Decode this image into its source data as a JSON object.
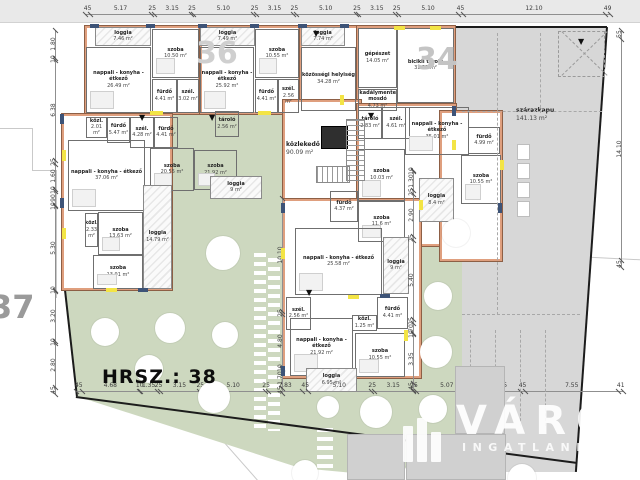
{
  "title": {
    "hrsz_label": "HRSZ.: 38"
  },
  "parcel_numbers": {
    "left": "37",
    "middle": "36",
    "right": "34"
  },
  "watermark": {
    "line1": "VÁROS",
    "line2": "INGATLANIRODA"
  },
  "colors": {
    "garden_green": "#cdd8bf",
    "pavement_gray": "#d7d7d7",
    "wall_salmon": "#df9f7e",
    "window_blue": "#3d5377",
    "marker_yellow": "#f3e445"
  },
  "rooms": [
    {
      "name": "loggia",
      "area": "7.46 m²",
      "x": 95,
      "y": 27,
      "w": 56,
      "h": 19,
      "k": "l"
    },
    {
      "name": "szoba",
      "area": "10.50 m²",
      "x": 152,
      "y": 29,
      "w": 47,
      "h": 49,
      "k": "r",
      "f": 1
    },
    {
      "name": "nappali - konyha - étkező",
      "area": "26.49 m²",
      "x": 86,
      "y": 47,
      "w": 65,
      "h": 66,
      "k": "r",
      "f": 1
    },
    {
      "name": "fürdő",
      "area": "4.41 m²",
      "x": 152,
      "y": 79,
      "w": 25,
      "h": 34,
      "k": "r"
    },
    {
      "name": "szél.",
      "area": "3.02 m²",
      "x": 177,
      "y": 79,
      "w": 22,
      "h": 34,
      "k": "r"
    },
    {
      "name": "loggia",
      "area": "7.49 m²",
      "x": 200,
      "y": 27,
      "w": 55,
      "h": 19,
      "k": "l"
    },
    {
      "name": "szoba",
      "area": "10.55 m²",
      "x": 255,
      "y": 29,
      "w": 44,
      "h": 49,
      "k": "r",
      "f": 1
    },
    {
      "name": "nappali - konyha - étkező",
      "area": "25.92 m²",
      "x": 200,
      "y": 47,
      "w": 54,
      "h": 66,
      "k": "r",
      "f": 1
    },
    {
      "name": "fürdő",
      "area": "4.41 m²",
      "x": 255,
      "y": 79,
      "w": 23,
      "h": 34,
      "k": "r"
    },
    {
      "name": "szél.",
      "area": "2.56 m²",
      "x": 278,
      "y": 79,
      "w": 21,
      "h": 34,
      "k": "r"
    },
    {
      "name": "loggia",
      "area": "7.74 m²",
      "x": 301,
      "y": 27,
      "w": 44,
      "h": 19,
      "k": "l"
    },
    {
      "name": "közösségi helyiség",
      "area": "34.28 m²",
      "x": 301,
      "y": 47,
      "w": 55,
      "h": 64,
      "k": "r"
    },
    {
      "name": "gépészet",
      "area": "14.05 m²",
      "x": 358,
      "y": 28,
      "w": 39,
      "h": 60,
      "k": "r"
    },
    {
      "name": "bicikli tároló",
      "area": "31.37 m²",
      "x": 397,
      "y": 28,
      "w": 57,
      "h": 75,
      "k": "r"
    },
    {
      "name": "akadálymentes mosdó",
      "area": "4.73 m²",
      "x": 358,
      "y": 89,
      "w": 39,
      "h": 22,
      "k": "r"
    },
    {
      "name": "közl.",
      "area": "2.01 m²",
      "x": 86,
      "y": 117,
      "w": 21,
      "h": 21,
      "k": "r"
    },
    {
      "name": "fürdő",
      "area": "5.47 m²",
      "x": 107,
      "y": 117,
      "w": 23,
      "h": 26,
      "k": "r"
    },
    {
      "name": "szél.",
      "area": "4.28 m²",
      "x": 130,
      "y": 117,
      "w": 24,
      "h": 31,
      "k": "r"
    },
    {
      "name": "fürdő",
      "area": "4.41 m²",
      "x": 154,
      "y": 117,
      "w": 24,
      "h": 31,
      "k": "r"
    },
    {
      "name": "tároló",
      "area": "2.56 m²",
      "x": 215,
      "y": 111,
      "w": 24,
      "h": 26,
      "k": "r"
    },
    {
      "name": "nappali - konyha - étkező",
      "area": "37.06 m²",
      "x": 68,
      "y": 140,
      "w": 77,
      "h": 71,
      "k": "r",
      "f": 1
    },
    {
      "name": "szoba",
      "area": "20.55 m²",
      "x": 150,
      "y": 148,
      "w": 44,
      "h": 43,
      "k": "r",
      "f": 1
    },
    {
      "name": "szoba",
      "area": "21.92 m²",
      "x": 194,
      "y": 150,
      "w": 43,
      "h": 40,
      "k": "r",
      "f": 1
    },
    {
      "name": "közl.",
      "area": "2.33 m²",
      "x": 85,
      "y": 213,
      "w": 13,
      "h": 34,
      "k": "r"
    },
    {
      "name": "szoba",
      "area": "13.63 m²",
      "x": 98,
      "y": 212,
      "w": 45,
      "h": 43,
      "k": "r",
      "f": 1
    },
    {
      "name": "szoba",
      "area": "13.91 m²",
      "x": 93,
      "y": 255,
      "w": 50,
      "h": 34,
      "k": "r",
      "f": 1
    },
    {
      "name": "loggia",
      "area": "14.79 m²",
      "x": 143,
      "y": 185,
      "w": 29,
      "h": 104,
      "k": "l"
    },
    {
      "name": "loggia",
      "area": "9 m²",
      "x": 210,
      "y": 176,
      "w": 52,
      "h": 23,
      "k": "l"
    },
    {
      "name": "tároló",
      "area": "2.83 m²",
      "x": 358,
      "y": 107,
      "w": 24,
      "h": 32,
      "k": "r"
    },
    {
      "name": "szél.",
      "area": "4.61 m²",
      "x": 382,
      "y": 107,
      "w": 28,
      "h": 32,
      "k": "r"
    },
    {
      "name": "nappali - konyha - étkező",
      "area": "35.01 m²",
      "x": 405,
      "y": 107,
      "w": 64,
      "h": 48,
      "k": "r",
      "f": 1
    },
    {
      "name": "szoba",
      "area": "10.03 m²",
      "x": 358,
      "y": 149,
      "w": 47,
      "h": 52,
      "k": "r",
      "f": 1
    },
    {
      "name": "fürdő",
      "area": "4.37 m²",
      "x": 330,
      "y": 191,
      "w": 28,
      "h": 31,
      "k": "r"
    },
    {
      "name": "szoba",
      "area": "11.6 m²",
      "x": 358,
      "y": 201,
      "w": 47,
      "h": 41,
      "k": "r",
      "f": 1
    },
    {
      "name": "fürdő",
      "area": "4.99 m²",
      "x": 468,
      "y": 127,
      "w": 32,
      "h": 27,
      "k": "r"
    },
    {
      "name": "szoba",
      "area": "10.55 m²",
      "x": 461,
      "y": 155,
      "w": 40,
      "h": 49,
      "k": "r",
      "f": 1
    },
    {
      "name": "loggia",
      "area": "8.4 m²",
      "x": 419,
      "y": 178,
      "w": 35,
      "h": 44,
      "k": "l"
    },
    {
      "name": "nappali - konyha - étkező",
      "area": "25.58 m²",
      "x": 295,
      "y": 228,
      "w": 87,
      "h": 67,
      "k": "r",
      "f": 1
    },
    {
      "name": "loggia",
      "area": "9 m²",
      "x": 383,
      "y": 237,
      "w": 26,
      "h": 57,
      "k": "l"
    },
    {
      "name": "szél.",
      "area": "2.56 m²",
      "x": 286,
      "y": 297,
      "w": 25,
      "h": 33,
      "k": "r"
    },
    {
      "name": "fürdő",
      "area": "4.41 m²",
      "x": 377,
      "y": 297,
      "w": 31,
      "h": 32,
      "k": "r"
    },
    {
      "name": "közl.",
      "area": "1.25 m²",
      "x": 352,
      "y": 315,
      "w": 25,
      "h": 16,
      "k": "r"
    },
    {
      "name": "nappali - konyha - étkező",
      "area": "21.92 m²",
      "x": 290,
      "y": 318,
      "w": 63,
      "h": 58,
      "k": "r",
      "f": 1
    },
    {
      "name": "szoba",
      "area": "10.55 m²",
      "x": 355,
      "y": 333,
      "w": 50,
      "h": 44,
      "k": "r",
      "f": 1
    },
    {
      "name": "loggia",
      "area": "6.95 m²",
      "x": 306,
      "y": 368,
      "w": 51,
      "h": 24,
      "k": "l"
    },
    {
      "name": "szárazkapu",
      "area": "141.13 m²",
      "x": 516,
      "y": 106,
      "w": 60,
      "h": 18,
      "k": "t"
    },
    {
      "name": "közlekedő",
      "area": "90.09 m²",
      "x": 286,
      "y": 140,
      "w": 52,
      "h": 18,
      "k": "t"
    }
  ],
  "blocks": [
    [
      85,
      26,
      115,
      88
    ],
    [
      200,
      26,
      100,
      88
    ],
    [
      300,
      26,
      58,
      86
    ],
    [
      357,
      26,
      98,
      86
    ],
    [
      62,
      114,
      110,
      176
    ],
    [
      283,
      100,
      78,
      130
    ],
    [
      357,
      104,
      99,
      142
    ],
    [
      440,
      111,
      62,
      150
    ],
    [
      283,
      199,
      138,
      179
    ]
  ],
  "dimension_chains": [
    {
      "dir": "h",
      "x": 85,
      "y": 14,
      "scale": 11.7,
      "segments": [
        [
          "45",
          0.45
        ],
        [
          "5.17",
          5.17
        ],
        [
          "25",
          0.25
        ],
        [
          "3.15",
          3.15
        ],
        [
          "25",
          0.25
        ],
        [
          "5.10",
          5.1
        ],
        [
          "25",
          0.25
        ],
        [
          "3.15",
          3.15
        ],
        [
          "25",
          0.25
        ],
        [
          "5.10",
          5.1
        ],
        [
          "25",
          0.25
        ],
        [
          "3.15",
          3.15
        ],
        [
          "25",
          0.25
        ],
        [
          "5.10",
          5.1
        ],
        [
          "45",
          0.45
        ],
        [
          "12.10",
          12.1
        ],
        [
          "49",
          0.49
        ]
      ]
    },
    {
      "dir": "h",
      "x": 76,
      "y": 391,
      "scale": 12.3,
      "segments": [
        [
          "45",
          0.45
        ],
        [
          "4.68",
          4.68
        ],
        [
          "10",
          0.1
        ],
        [
          "1.35",
          1.35
        ],
        [
          "25",
          0.25
        ],
        [
          "3.15",
          3.15
        ],
        [
          "25",
          0.25
        ],
        [
          "5.10",
          5.1
        ],
        [
          "25",
          0.25
        ],
        [
          "2.83",
          2.83
        ],
        [
          "45",
          0.45
        ],
        [
          "5.10",
          5.1
        ],
        [
          "25",
          0.25
        ],
        [
          "3.15",
          3.15
        ],
        [
          "25",
          0.25
        ],
        [
          "5.07",
          5.07
        ],
        [
          "25",
          0.25
        ],
        [
          "3.15",
          3.15
        ],
        [
          "45",
          0.45
        ],
        [
          "7.55",
          7.55
        ],
        [
          "41",
          0.41
        ]
      ]
    },
    {
      "dir": "v",
      "x": 55,
      "y": 30,
      "scale": 15.7,
      "segments": [
        [
          "1.80",
          1.8
        ],
        [
          "10",
          0.1
        ],
        [
          "6.38",
          6.38
        ],
        [
          "25",
          0.25
        ],
        [
          "1.60",
          1.6
        ],
        [
          "10",
          0.1
        ],
        [
          "90",
          0.9
        ],
        [
          "10",
          0.1
        ],
        [
          "5.30",
          5.3
        ],
        [
          "10",
          0.1
        ],
        [
          "3.20",
          3.2
        ],
        [
          "10",
          0.1
        ],
        [
          "2.80",
          2.8
        ],
        [
          "45",
          0.45
        ]
      ]
    },
    {
      "dir": "v",
      "x": 621,
      "y": 30,
      "scale": 15.7,
      "segments": [
        [
          "55",
          0.55
        ],
        [
          "14.10",
          14.1
        ],
        [
          "45",
          0.45
        ]
      ]
    },
    {
      "dir": "v",
      "x": 413,
      "y": 170,
      "scale": 14.6,
      "segments": [
        [
          "10",
          0.1
        ],
        [
          "1.30",
          1.3
        ],
        [
          "25",
          0.25
        ],
        [
          "2.90",
          2.9
        ],
        [
          "25",
          0.25
        ],
        [
          "5.40",
          5.4
        ],
        [
          "25",
          0.25
        ],
        [
          "70",
          0.7
        ],
        [
          "10",
          0.1
        ],
        [
          "3.35",
          3.35
        ],
        [
          "45",
          0.45
        ]
      ]
    },
    {
      "dir": "v",
      "x": 282,
      "y": 198,
      "scale": 11.2,
      "segments": [
        [
          "10.10",
          10.1
        ],
        [
          "25",
          0.25
        ],
        [
          "4.80",
          4.8
        ],
        [
          "10",
          0.1
        ],
        [
          "1.70",
          1.7
        ],
        [
          "45",
          0.45
        ]
      ]
    }
  ],
  "trees": [
    [
      223,
      253,
      17
    ],
    [
      456,
      233,
      14
    ],
    [
      438,
      296,
      14
    ],
    [
      105,
      332,
      14
    ],
    [
      170,
      328,
      15
    ],
    [
      225,
      335,
      13
    ],
    [
      149,
      369,
      14
    ],
    [
      214,
      397,
      16
    ],
    [
      436,
      352,
      16
    ],
    [
      376,
      412,
      16
    ],
    [
      433,
      409,
      14
    ],
    [
      328,
      407,
      11
    ],
    [
      417,
      474,
      13
    ],
    [
      522,
      478,
      14
    ],
    [
      305,
      473,
      13
    ]
  ],
  "yellow_markers": [
    [
      150,
      111,
      13,
      4
    ],
    [
      258,
      111,
      13,
      4
    ],
    [
      62,
      150,
      4,
      11
    ],
    [
      62,
      228,
      4,
      11
    ],
    [
      394,
      26,
      11,
      4
    ],
    [
      430,
      26,
      11,
      4
    ],
    [
      340,
      95,
      4,
      10
    ],
    [
      452,
      140,
      4,
      10
    ],
    [
      281,
      248,
      4,
      11
    ],
    [
      348,
      295,
      11,
      4
    ],
    [
      404,
      330,
      4,
      11
    ],
    [
      106,
      288,
      11,
      4
    ],
    [
      419,
      200,
      4,
      10
    ],
    [
      500,
      160,
      4,
      10
    ]
  ],
  "blue_markers": [
    [
      90,
      24,
      9,
      4
    ],
    [
      146,
      24,
      9,
      4
    ],
    [
      198,
      24,
      9,
      4
    ],
    [
      250,
      24,
      9,
      4
    ],
    [
      298,
      24,
      9,
      4
    ],
    [
      340,
      24,
      9,
      4
    ],
    [
      60,
      114,
      4,
      10
    ],
    [
      60,
      198,
      4,
      10
    ],
    [
      138,
      288,
      10,
      4
    ],
    [
      281,
      203,
      4,
      10
    ],
    [
      281,
      366,
      4,
      10
    ],
    [
      452,
      106,
      4,
      10
    ],
    [
      498,
      203,
      4,
      10
    ],
    [
      380,
      294,
      10,
      4
    ]
  ],
  "entry_arrows": [
    [
      313,
      30
    ],
    [
      139,
      114
    ],
    [
      209,
      114
    ],
    [
      368,
      112
    ],
    [
      306,
      289
    ],
    [
      578,
      38
    ]
  ],
  "parking_stalls": [
    [
      517,
      144,
      13,
      16
    ],
    [
      517,
      163,
      13,
      16
    ],
    [
      517,
      182,
      13,
      16
    ],
    [
      517,
      201,
      13,
      16
    ]
  ],
  "dashed_lines": [
    {
      "x": 497,
      "y": 33,
      "w": 0,
      "h": 282
    },
    {
      "x": 540,
      "y": 33,
      "w": 0,
      "h": 80
    },
    {
      "x": 462,
      "y": 111,
      "w": 140,
      "h": 0
    },
    {
      "x": 462,
      "y": 314,
      "w": 118,
      "h": 0
    },
    {
      "x": 470,
      "y": 330,
      "w": 0,
      "h": 96
    },
    {
      "x": 495,
      "y": 330,
      "w": 0,
      "h": 96
    },
    {
      "x": 520,
      "y": 330,
      "w": 0,
      "h": 96
    },
    {
      "x": 545,
      "y": 330,
      "w": 0,
      "h": 96
    }
  ],
  "gray_buildings": [
    [
      347,
      434,
      58,
      46
    ],
    [
      406,
      434,
      100,
      46
    ],
    [
      455,
      366,
      50,
      68
    ]
  ]
}
